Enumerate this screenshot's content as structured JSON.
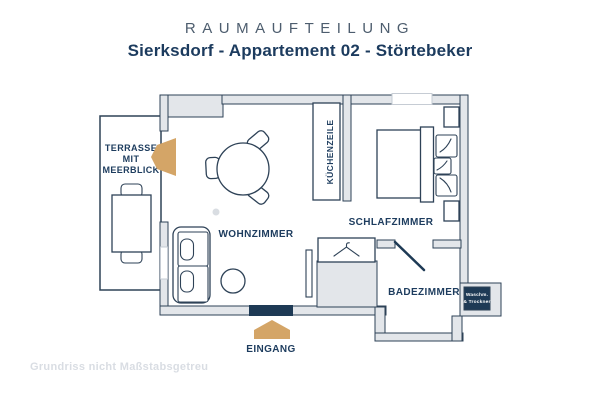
{
  "header": {
    "title": "RAUMAUFTEILUNG",
    "subtitle": "Sierksdorf - Appartement 02 - Störtebeker"
  },
  "plan": {
    "rooms": {
      "terrace": {
        "line1": "TERRASSE",
        "line2": "MIT",
        "line3": "MEERBLICK"
      },
      "living_room": "WOHNZIMMER",
      "kitchenette": "KÜCHENZEILE",
      "bedroom": "SCHLAFZIMMER",
      "bathroom": "BADEZIMMER",
      "entrance": "EINGANG"
    },
    "appliance_box": {
      "line1": "Waschm.",
      "line2": "& Trockner"
    },
    "icons": [
      "terrace-door-arrow-icon",
      "entrance-arrow-icon",
      "hanger-icon"
    ]
  },
  "footer": {
    "disclaimer": "Grundriss nicht Maßstabsgetreu"
  },
  "colors": {
    "label_navy": "#1d3c5e",
    "outline_navy": "#2e4257",
    "wall_gray": "#e3e6ea",
    "accent_tan": "#d4a567",
    "dark_navy": "#1e3a55",
    "title_gray": "#4d5d6e",
    "footer_gray": "#d9dde3"
  }
}
